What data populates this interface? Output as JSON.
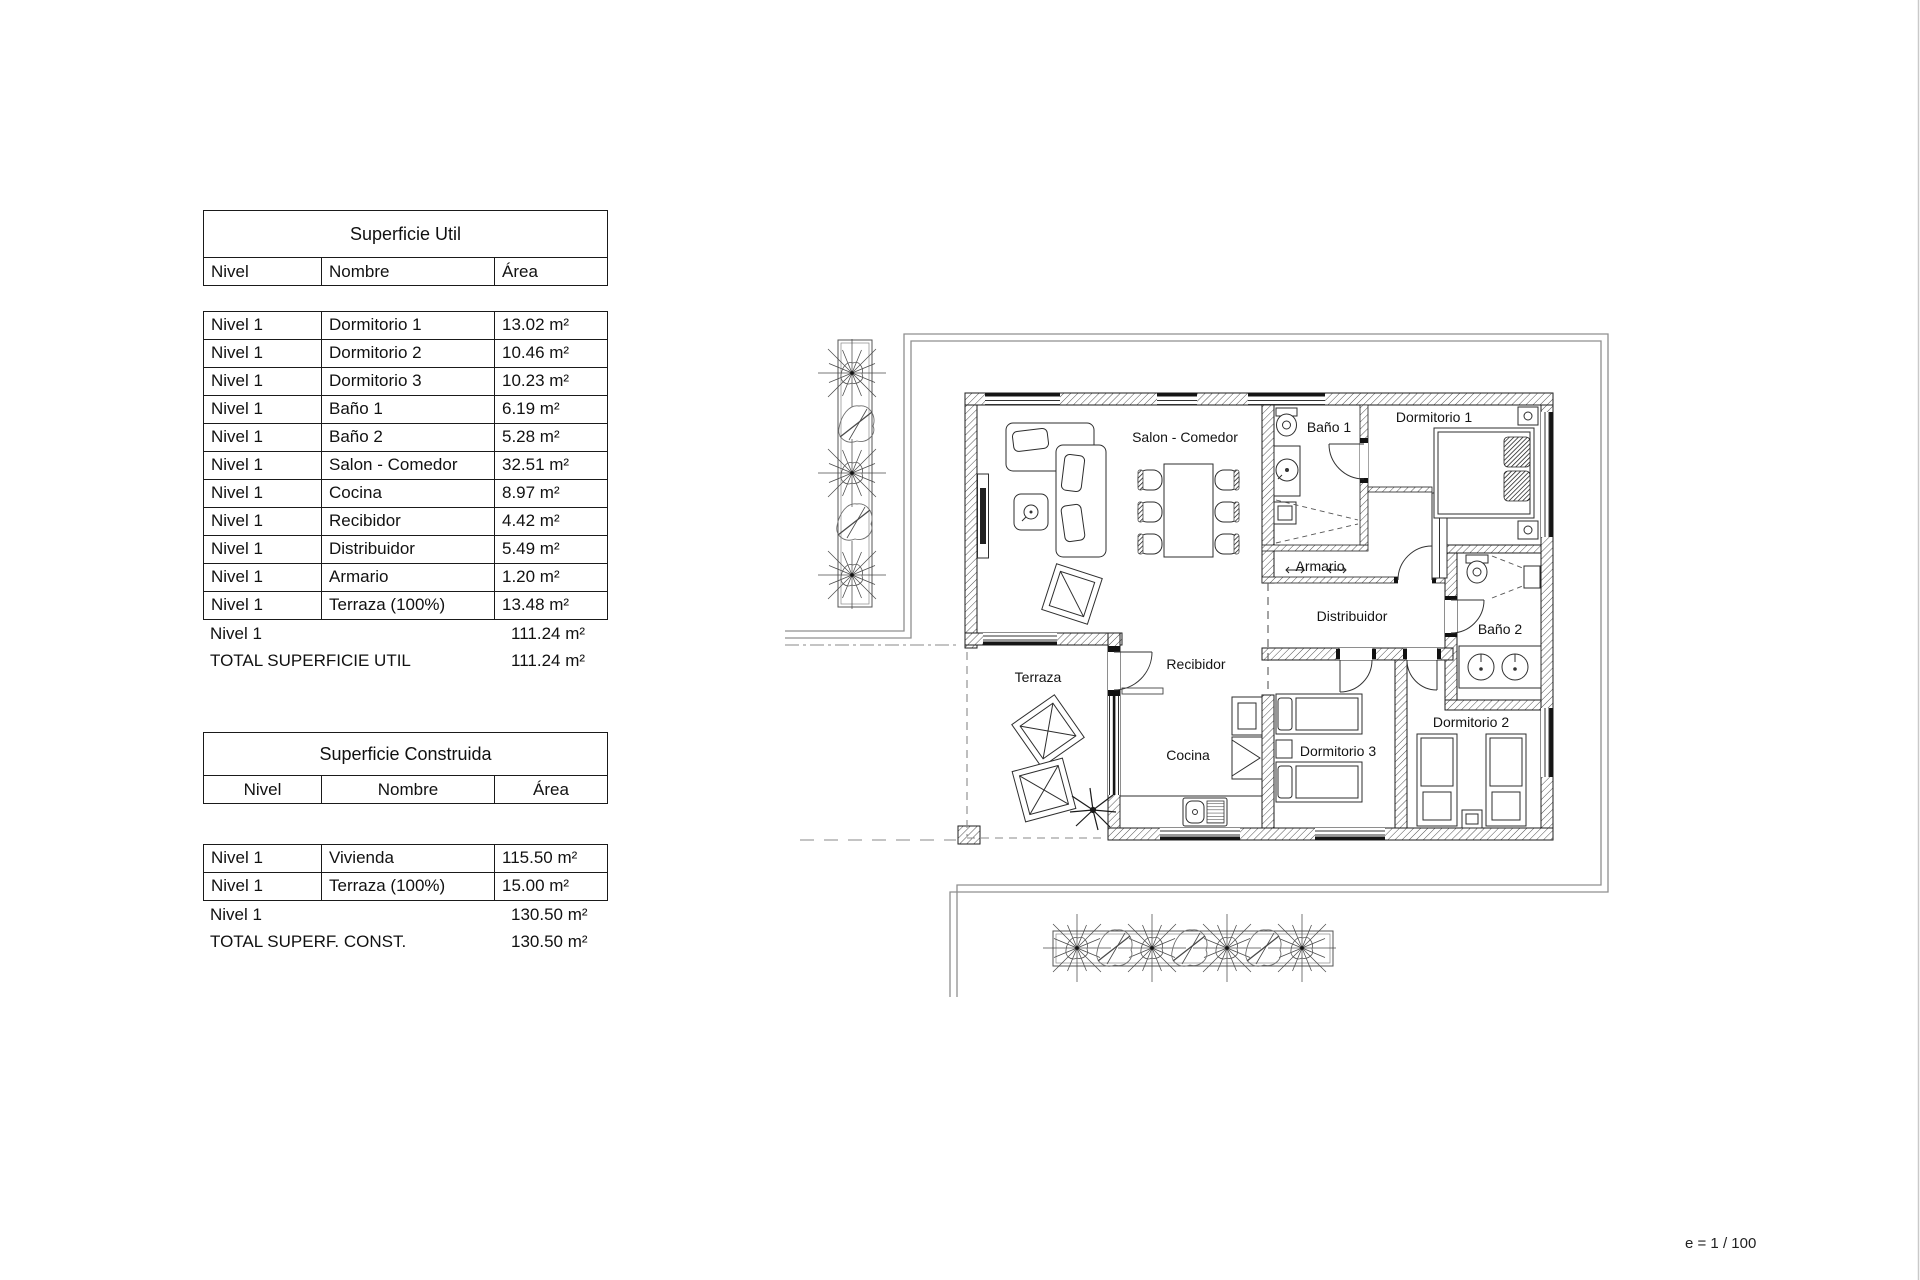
{
  "tables": {
    "util": {
      "title": "Superficie Util",
      "columns": [
        "Nivel",
        "Nombre",
        "Área"
      ],
      "rows": [
        {
          "nivel": "Nivel 1",
          "nombre": "Dormitorio 1",
          "area": "13.02 m²"
        },
        {
          "nivel": "Nivel 1",
          "nombre": "Dormitorio 2",
          "area": "10.46 m²"
        },
        {
          "nivel": "Nivel 1",
          "nombre": "Dormitorio 3",
          "area": "10.23 m²"
        },
        {
          "nivel": "Nivel 1",
          "nombre": "Baño 1",
          "area": "6.19 m²"
        },
        {
          "nivel": "Nivel 1",
          "nombre": "Baño 2",
          "area": "5.28 m²"
        },
        {
          "nivel": "Nivel 1",
          "nombre": "Salon - Comedor",
          "area": "32.51 m²"
        },
        {
          "nivel": "Nivel 1",
          "nombre": "Cocina",
          "area": "8.97 m²"
        },
        {
          "nivel": "Nivel 1",
          "nombre": "Recibidor",
          "area": "4.42 m²"
        },
        {
          "nivel": "Nivel 1",
          "nombre": "Distribuidor",
          "area": "5.49 m²"
        },
        {
          "nivel": "Nivel 1",
          "nombre": "Armario",
          "area": "1.20 m²"
        },
        {
          "nivel": "Nivel 1",
          "nombre": "Terraza (100%)",
          "area": "13.48 m²"
        }
      ],
      "subtotal": {
        "label": "Nivel 1",
        "area": "111.24 m²"
      },
      "total": {
        "label": "TOTAL SUPERFICIE UTIL",
        "area": "111.24 m²"
      }
    },
    "construida": {
      "title": "Superficie Construida",
      "columns": [
        "Nivel",
        "Nombre",
        "Área"
      ],
      "rows": [
        {
          "nivel": "Nivel 1",
          "nombre": "Vivienda",
          "area": "115.50 m²"
        },
        {
          "nivel": "Nivel 1",
          "nombre": "Terraza (100%)",
          "area": "15.00 m²"
        }
      ],
      "subtotal": {
        "label": "Nivel 1",
        "area": "130.50 m²"
      },
      "total": {
        "label": "TOTAL SUPERF. CONST.",
        "area": "130.50 m²"
      }
    }
  },
  "plan": {
    "labels": {
      "salon": "Salon - Comedor",
      "bano1": "Baño 1",
      "dorm1": "Dormitorio 1",
      "armario": "Armario",
      "distribuidor": "Distribuidor",
      "bano2": "Baño 2",
      "terraza": "Terraza",
      "recibidor": "Recibidor",
      "cocina": "Cocina",
      "dorm3": "Dormitorio 3",
      "dorm2": "Dormitorio 2"
    },
    "scale_note": "e = 1 / 100"
  }
}
